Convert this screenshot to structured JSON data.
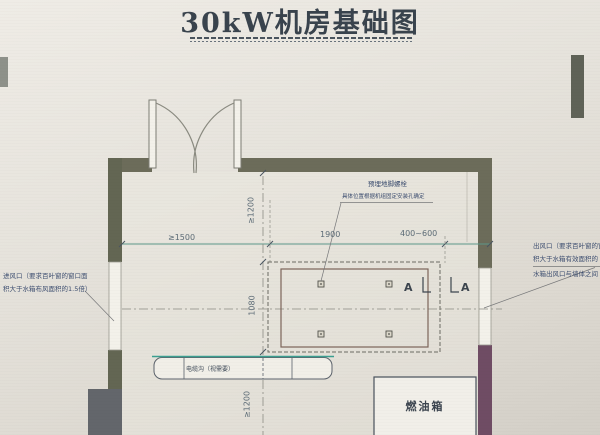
{
  "title": "30kW机房基础图",
  "notes": {
    "anchor_line1": "预埋地脚螺栓",
    "anchor_line2": "具体位置根据机组固定安装孔确定",
    "inlet_line1": "进风口（要求百叶窗的窗口面",
    "inlet_line2": "积大于水箱布风面积的1.5倍）",
    "outlet_line1": "出风口（要求百叶窗的窗",
    "outlet_line2": "积大于水箱有效面积的",
    "outlet_line3": "水箱出风口与墙体之间",
    "cable_trench": "电缆沟（视需要）",
    "fuel_tank": "燃油箱"
  },
  "dimensions": {
    "width_left": "≥1500",
    "width_center": "1900",
    "width_right": "400~600",
    "depth_top": "≥1200",
    "depth_center": "1080",
    "depth_bottom": "≥1200"
  },
  "section_label": "A",
  "colors": {
    "wall": "#6c6c5a",
    "wall_accent_purple": "#6f4c64",
    "dimension_line": "#5b9688",
    "note_text": "#3d4e70",
    "title_text": "#39434d",
    "paper": "#e4e1da"
  }
}
